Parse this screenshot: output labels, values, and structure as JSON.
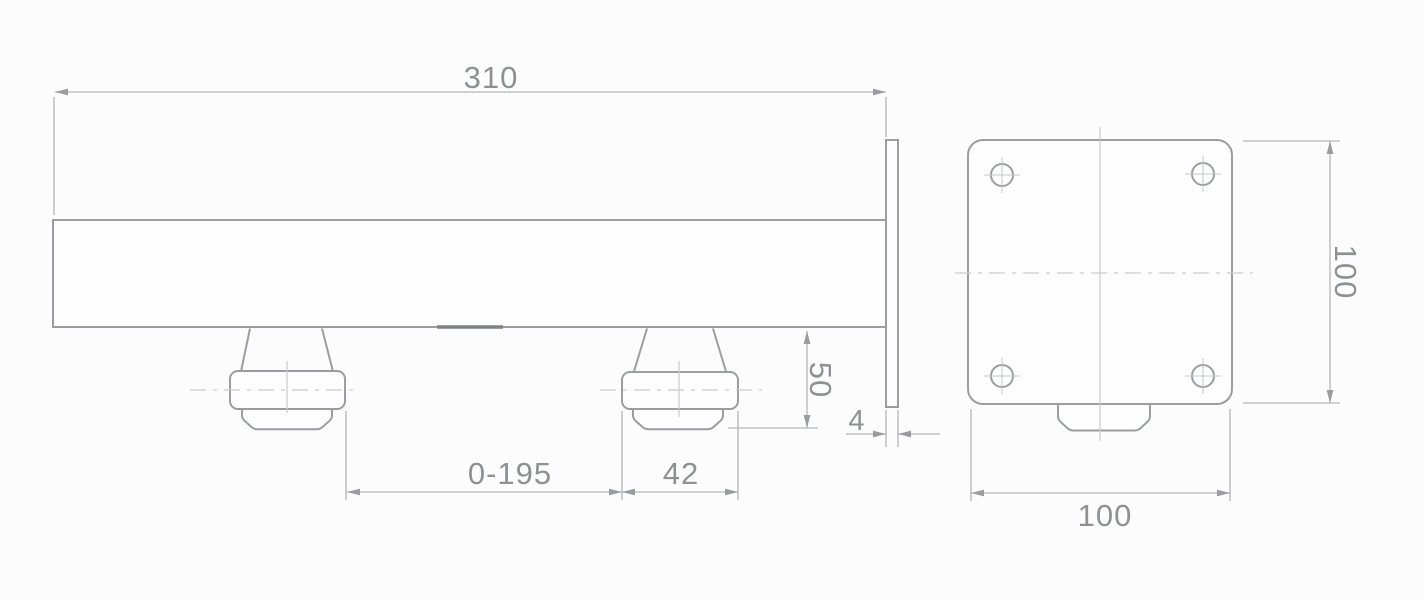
{
  "colors": {
    "background": "#fcfcfd",
    "outline": "#9b9da0",
    "dimension_line": "#b4b6b8",
    "centerline": "#c9cbcd",
    "text": "#8e9093"
  },
  "drawing": {
    "side_view": "rail-with-adjustable-rollers-and-end-plate",
    "front_view": "mounting-plate-with-four-holes"
  },
  "dimensions": {
    "rail_length": "310",
    "roller_drop": "50",
    "plate_thickness": "4",
    "adjust_range": "0-195",
    "roller_width": "42",
    "plate_height": "100",
    "plate_width": "100"
  }
}
